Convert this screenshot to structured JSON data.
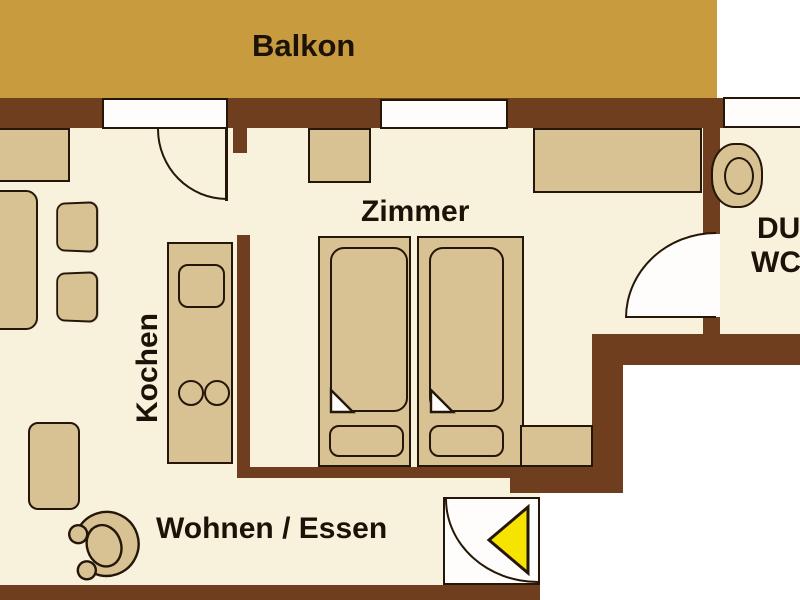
{
  "labels": {
    "balcony": "Balkon",
    "bedroom": "Zimmer",
    "kitchen": "Kochen",
    "living_dining": "Wohnen / Essen",
    "bath_line1": "DU",
    "bath_line2": "WC"
  },
  "colors": {
    "balcony": "#C79B3E",
    "wall": "#6E3E1F",
    "floor": "#F8F1DB",
    "furniture": "#D8C294",
    "outline": "#241608",
    "exterior": "#FFFFFF",
    "arrow": "#F6E400",
    "label": "#1C1207"
  }
}
